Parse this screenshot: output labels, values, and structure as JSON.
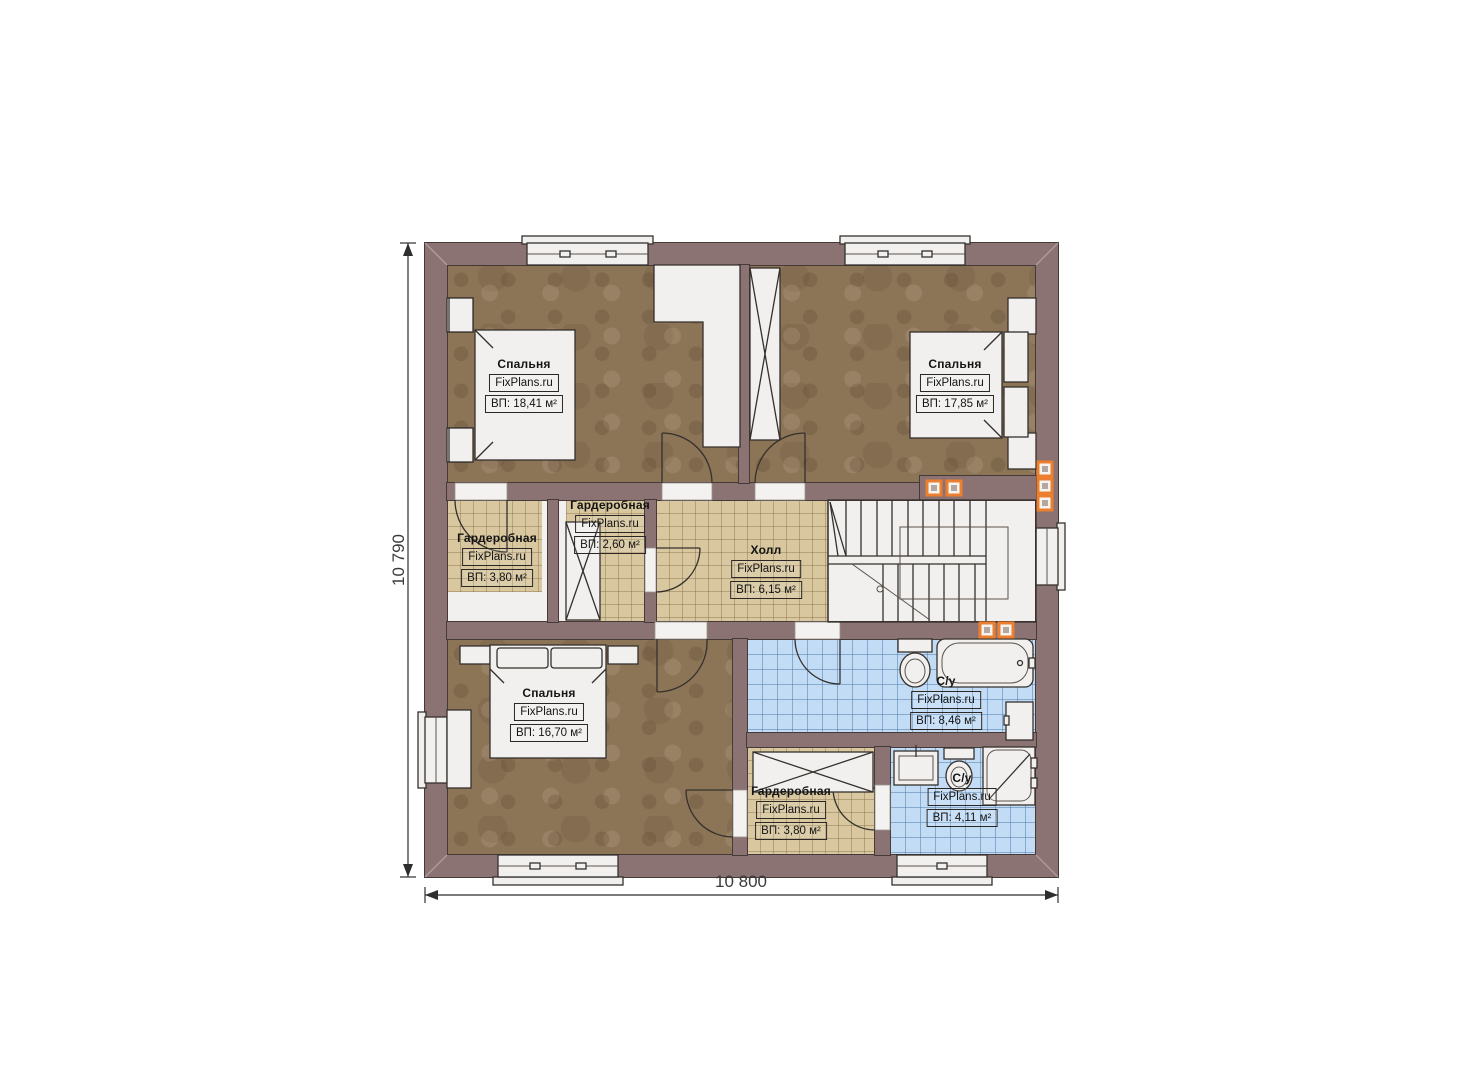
{
  "watermark": "FixPlans.ru",
  "dimensions": {
    "width": "10 800",
    "height": "10 790"
  },
  "rooms": [
    {
      "name": "Спальня",
      "area": "ВП: 18,41 м²"
    },
    {
      "name": "Спальня",
      "area": "ВП: 17,85 м²"
    },
    {
      "name": "Гардеробная",
      "area": "ВП: 3,80 м²"
    },
    {
      "name": "Гардеробная",
      "area": "ВП: 2,60 м²"
    },
    {
      "name": "Холл",
      "area": "ВП: 6,15 м²"
    },
    {
      "name": "Спальня",
      "area": "ВП: 16,70 м²"
    },
    {
      "name": "С/у",
      "area": "ВП: 8,46 м²"
    },
    {
      "name": "Гардеробная",
      "area": "ВП: 3,80 м²"
    },
    {
      "name": "С/у",
      "area": "ВП: 4,11 м²"
    }
  ],
  "palette": {
    "wall": "#8a7372",
    "wood_floor": "#8c7457",
    "tile_beige": "#d8c79f",
    "tile_blue": "#c2dcf5",
    "accent_orange": "#ec7f2f",
    "background": "#ffffff"
  }
}
